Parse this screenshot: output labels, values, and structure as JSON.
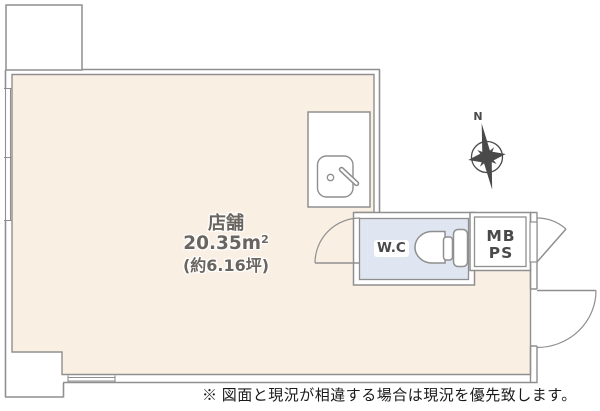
{
  "floor_plan": {
    "room": {
      "name": "店舗",
      "area": "20.35",
      "area_unit": "m",
      "area_unit_sup": "2",
      "area_alt": "(約6.16坪)"
    },
    "wc": {
      "label": "W.C"
    },
    "utility": {
      "line1": "MB",
      "line2": "PS"
    },
    "compass": {
      "label": "N"
    },
    "note": "※ 図面と現況が相違する場合は現況を優先致します。",
    "colors": {
      "room_fill": "#FAEFE3",
      "wc_fill": "#DFE5F1",
      "wall_line": "#8F8F8F",
      "room_label_text": "#6B655F",
      "small_label_text": "#4A4A4A",
      "compass_color": "#4A4A4A",
      "note_text": "#1A1A1A"
    }
  }
}
